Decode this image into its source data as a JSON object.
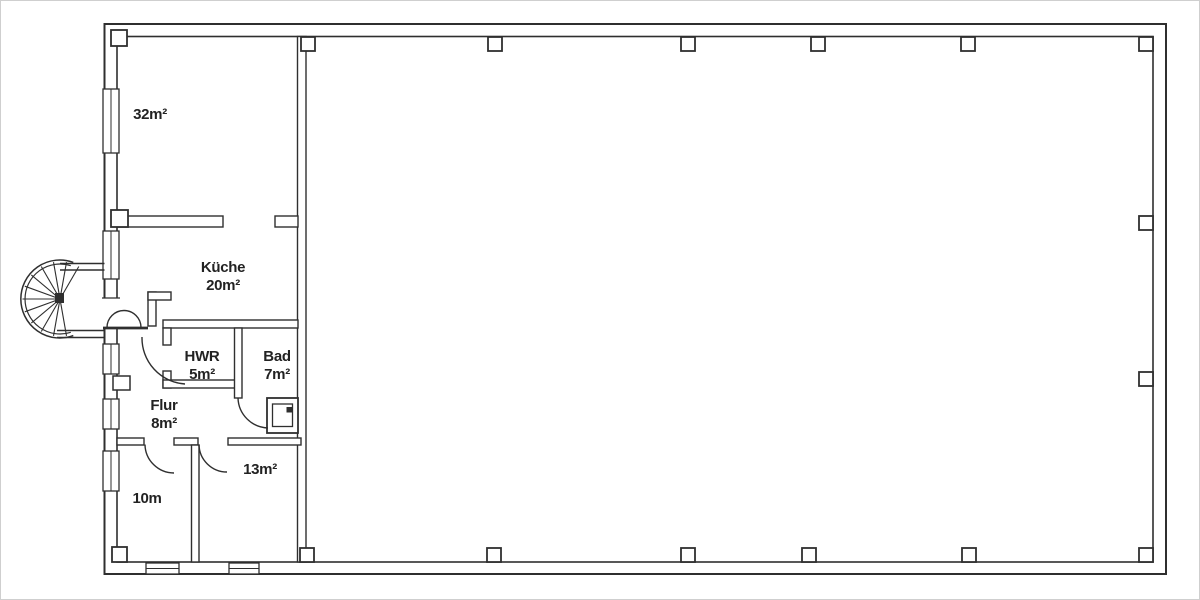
{
  "title": "Grundriss / floor plan",
  "rooms": [
    {
      "id": "room-32",
      "label": "32m²"
    },
    {
      "id": "kueche",
      "label": "Küche",
      "area": "20m²"
    },
    {
      "id": "hwr",
      "label": "HWR",
      "area": "5m²"
    },
    {
      "id": "bad",
      "label": "Bad",
      "area": "7m²"
    },
    {
      "id": "flur",
      "label": "Flur",
      "area": "8m²"
    },
    {
      "id": "room-10",
      "label": "10m"
    },
    {
      "id": "room-13",
      "label": "13m²"
    }
  ],
  "colors": {
    "wall": "#2f2f2f",
    "text": "#222222",
    "background": "#ffffff",
    "frame": "#cfcfcf"
  }
}
